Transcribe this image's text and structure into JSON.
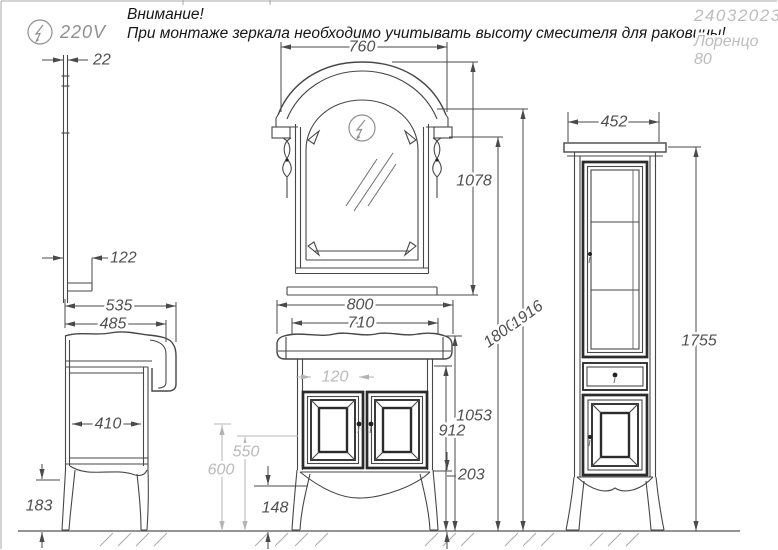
{
  "page": {
    "background": "#ffffff",
    "border_color": "#a8a8a8"
  },
  "header": {
    "warning_title": "Внимание!",
    "warning_text": "При монтаже зеркала необходимо учитывать высоту смесителя для раковины!",
    "voltage_label": "220V",
    "doc_number": "24032023",
    "product_name": "Лоренцо",
    "product_size": "80"
  },
  "icons": {
    "power_symbol": "lightning-in-circle"
  },
  "colors": {
    "line": "#474747",
    "bold_line": "#2b2b2b",
    "primary_dim_text": "#4f4f4f",
    "secondary_dim": "#b4b4b4",
    "gray_text": "#8f8f8f",
    "light_gray_text": "#bdbdbd"
  },
  "dimensions": {
    "mirror_thickness": "22",
    "shelf_depth": "122",
    "depth_total": "535",
    "depth_basin": "485",
    "depth_cabinet": "410",
    "leg_height": "183",
    "mirror_width": "760",
    "mirror_height": "1078",
    "basin_width": "800",
    "cabinet_width": "710",
    "center_gap": "120",
    "height_lamp": "1800",
    "height_total": "1916",
    "height_basin_top": "1053",
    "height_countertop_bottom": "912",
    "plinth": "203",
    "apron_clearance": "148",
    "ref_600": "600",
    "ref_550": "550",
    "column_width": "452",
    "column_height": "1755"
  }
}
